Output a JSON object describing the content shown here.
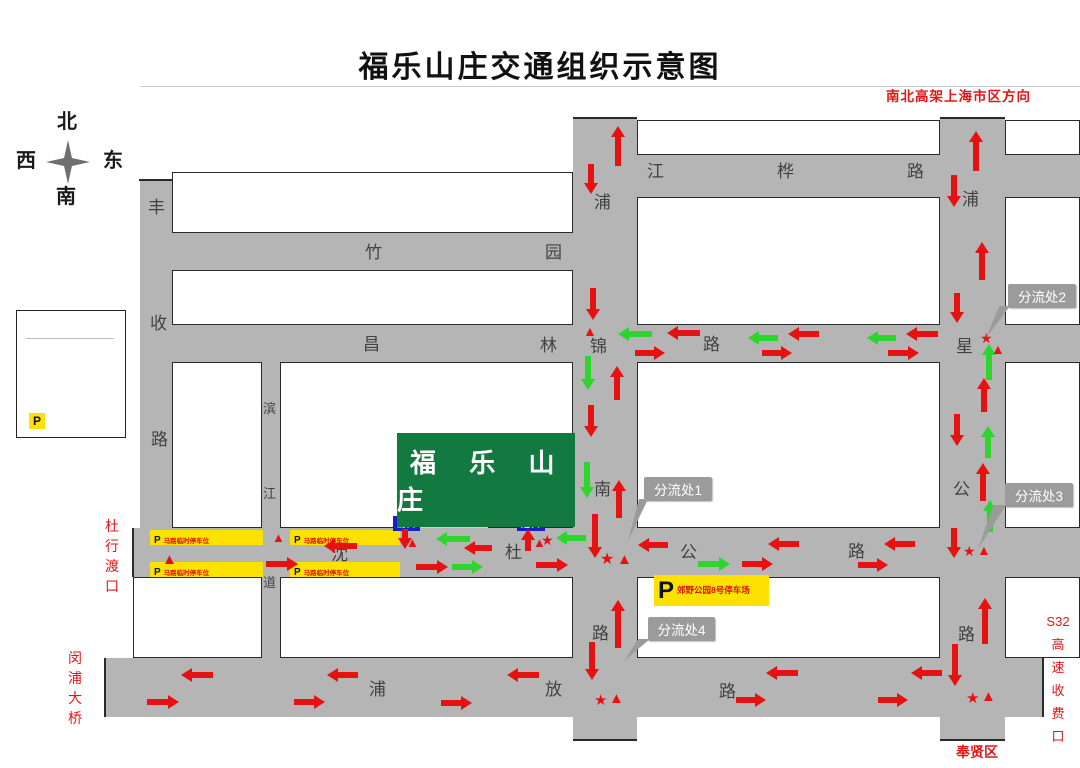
{
  "title": "福乐山庄交通组织示意图",
  "compass": {
    "north": "北",
    "south": "南",
    "east": "东",
    "west": "西"
  },
  "legend": {
    "title": "图 例",
    "items": [
      {
        "symbol": "star",
        "label": "交警岗位"
      },
      {
        "symbol": "triangle",
        "label": "特勤岗位"
      },
      {
        "symbol": "red-arrow",
        "label": "通行线路"
      },
      {
        "symbol": "green-arrow",
        "label": "短驳车通行线路"
      },
      {
        "symbol": "parking",
        "label": "停车位"
      }
    ],
    "parking_symbol": "P"
  },
  "colors": {
    "road": "#b5b5b5",
    "red": "#e61111",
    "green": "#2ed52e",
    "site_green": "#127a40",
    "yellow": "#ffe100",
    "blue": "#1c1ccd",
    "callout": "#9b9b9b",
    "label_red": "#e01717"
  },
  "roads": [
    {
      "id": "fengshou-rd",
      "rect": [
        140,
        180,
        33,
        398
      ]
    },
    {
      "id": "binjiang-lane",
      "rect": [
        262,
        362,
        18,
        296
      ]
    },
    {
      "id": "pujinnan-rd",
      "rect": [
        573,
        118,
        64,
        622
      ]
    },
    {
      "id": "puxing-hwy",
      "rect": [
        940,
        118,
        65,
        622
      ]
    },
    {
      "id": "jianghua-rd",
      "rect": [
        573,
        155,
        507,
        42
      ]
    },
    {
      "id": "zhuyuan-rd",
      "rect": [
        140,
        233,
        497,
        37
      ]
    },
    {
      "id": "changlin-rd",
      "rect": [
        140,
        325,
        940,
        37
      ]
    },
    {
      "id": "shendu-hwy",
      "rect": [
        133,
        528,
        947,
        49
      ]
    },
    {
      "id": "pufang-rd",
      "rect": [
        105,
        658,
        938,
        59
      ]
    }
  ],
  "road_chars": [
    {
      "t": "江",
      "x": 647,
      "y": 163
    },
    {
      "t": "桦",
      "x": 777,
      "y": 163
    },
    {
      "t": "路",
      "x": 907,
      "y": 163
    },
    {
      "t": "竹",
      "x": 365,
      "y": 244
    },
    {
      "t": "园",
      "x": 545,
      "y": 244
    },
    {
      "t": "昌",
      "x": 363,
      "y": 336
    },
    {
      "t": "林",
      "x": 540,
      "y": 337
    },
    {
      "t": "路",
      "x": 703,
      "y": 336
    },
    {
      "t": "沈",
      "x": 331,
      "y": 546
    },
    {
      "t": "杜",
      "x": 505,
      "y": 544
    },
    {
      "t": "公",
      "x": 680,
      "y": 544
    },
    {
      "t": "路",
      "x": 848,
      "y": 543
    },
    {
      "t": "浦",
      "x": 369,
      "y": 681
    },
    {
      "t": "放",
      "x": 545,
      "y": 681
    },
    {
      "t": "路",
      "x": 719,
      "y": 683
    },
    {
      "t": "丰",
      "x": 148,
      "y": 199
    },
    {
      "t": "收",
      "x": 150,
      "y": 315
    },
    {
      "t": "路",
      "x": 151,
      "y": 431
    },
    {
      "t": "滨",
      "x": 263,
      "y": 402,
      "s": 13
    },
    {
      "t": "江",
      "x": 263,
      "y": 487,
      "s": 13
    },
    {
      "t": "道",
      "x": 263,
      "y": 576,
      "s": 13
    },
    {
      "t": "浦",
      "x": 594,
      "y": 194
    },
    {
      "t": "锦",
      "x": 590,
      "y": 338
    },
    {
      "t": "南",
      "x": 594,
      "y": 481
    },
    {
      "t": "路",
      "x": 592,
      "y": 625
    },
    {
      "t": "浦",
      "x": 962,
      "y": 191
    },
    {
      "t": "星",
      "x": 956,
      "y": 338
    },
    {
      "t": "公",
      "x": 953,
      "y": 481
    },
    {
      "t": "路",
      "x": 958,
      "y": 626
    }
  ],
  "blocks": [
    [
      637,
      120,
      303,
      35
    ],
    [
      1005,
      120,
      75,
      35
    ],
    [
      637,
      197,
      303,
      128
    ],
    [
      1005,
      197,
      75,
      128
    ],
    [
      172,
      172,
      401,
      61
    ],
    [
      172,
      270,
      401,
      55
    ],
    [
      172,
      362,
      90,
      166
    ],
    [
      280,
      362,
      293,
      166
    ],
    [
      637,
      362,
      303,
      166
    ],
    [
      1005,
      362,
      75,
      166
    ],
    [
      133,
      577,
      129,
      81
    ],
    [
      280,
      577,
      293,
      81
    ],
    [
      637,
      577,
      303,
      81
    ],
    [
      1005,
      577,
      75,
      81
    ]
  ],
  "caps": [
    [
      573,
      117,
      64,
      2
    ],
    [
      940,
      117,
      65,
      2
    ],
    [
      139,
      179,
      34,
      2
    ],
    [
      132,
      528,
      2,
      49
    ],
    [
      104,
      658,
      2,
      59
    ],
    [
      1042,
      658,
      2,
      59
    ],
    [
      573,
      739,
      64,
      2
    ],
    [
      940,
      739,
      65,
      2
    ]
  ],
  "site": {
    "name": "福 乐 山 庄",
    "rect": [
      397,
      433,
      178,
      94
    ]
  },
  "site_parking": {
    "p": "P",
    "label": "福乐山庄停车场",
    "rect": [
      412,
      505,
      76,
      23
    ]
  },
  "park8": {
    "p": "P",
    "label": "郊野公园8号停车场",
    "rect": [
      654,
      575,
      115,
      31
    ]
  },
  "gates": [
    {
      "id": "exit-gate",
      "label": "出口",
      "rect": [
        393,
        516,
        27,
        15
      ]
    },
    {
      "id": "entry-gate",
      "label": "进口",
      "rect": [
        517,
        516,
        28,
        15
      ]
    }
  ],
  "strips": [
    {
      "rect": [
        150,
        530,
        113,
        15
      ],
      "p": "P",
      "label": "马路临时停车位"
    },
    {
      "rect": [
        290,
        530,
        110,
        15
      ],
      "p": "P",
      "label": "马路临时停车位"
    },
    {
      "rect": [
        150,
        562,
        113,
        15
      ],
      "p": "P",
      "label": "马路临时停车位"
    },
    {
      "rect": [
        290,
        562,
        110,
        15
      ],
      "p": "P",
      "label": "马路临时停车位"
    }
  ],
  "callouts": [
    {
      "text": "分流处1",
      "rect": [
        644,
        477,
        68,
        24
      ],
      "tail": [
        628,
        499,
        20,
        42
      ]
    },
    {
      "text": "分流处2",
      "rect": [
        1008,
        284,
        68,
        24
      ],
      "tail": [
        986,
        306,
        24,
        32
      ]
    },
    {
      "text": "分流处3",
      "rect": [
        1005,
        483,
        68,
        24
      ],
      "tail": [
        978,
        505,
        28,
        44
      ]
    },
    {
      "text": "分流处4",
      "rect": [
        648,
        617,
        67,
        24
      ],
      "tail": [
        624,
        639,
        26,
        22
      ]
    }
  ],
  "red_labels": [
    {
      "text": "南北高架上海市区方向",
      "x": 886,
      "y": 90,
      "size": 13.5,
      "bold": true,
      "ls": 1
    },
    {
      "lines": [
        "杜",
        "行",
        "渡",
        "口"
      ],
      "x": 105,
      "y": 516,
      "size": 14,
      "lh": 20
    },
    {
      "lines": [
        "闵",
        "浦",
        "大",
        "桥"
      ],
      "x": 68,
      "y": 648,
      "size": 14,
      "lh": 20
    },
    {
      "lines": [
        "S32",
        "高",
        "速",
        "收",
        "费",
        "口"
      ],
      "x": 1040,
      "y": 610,
      "size": 13,
      "lh": 23,
      "w": 36
    },
    {
      "text": "奉贤区",
      "x": 956,
      "y": 745,
      "size": 14,
      "bold": true
    }
  ],
  "arrows": [
    [
      611,
      126,
      40,
      "u",
      "r"
    ],
    [
      584,
      164,
      30,
      "d",
      "r"
    ],
    [
      586,
      288,
      32,
      "d",
      "r"
    ],
    [
      581,
      356,
      34,
      "d",
      "g"
    ],
    [
      610,
      366,
      34,
      "u",
      "r"
    ],
    [
      584,
      405,
      32,
      "d",
      "r"
    ],
    [
      580,
      462,
      36,
      "d",
      "g"
    ],
    [
      612,
      480,
      38,
      "u",
      "r"
    ],
    [
      588,
      514,
      44,
      "d",
      "r"
    ],
    [
      585,
      642,
      38,
      "d",
      "r"
    ],
    [
      611,
      600,
      48,
      "u",
      "r"
    ],
    [
      969,
      131,
      40,
      "u",
      "r"
    ],
    [
      947,
      175,
      32,
      "d",
      "r"
    ],
    [
      975,
      242,
      38,
      "u",
      "r"
    ],
    [
      950,
      293,
      30,
      "d",
      "r"
    ],
    [
      982,
      344,
      36,
      "u",
      "g"
    ],
    [
      977,
      378,
      34,
      "u",
      "r"
    ],
    [
      950,
      414,
      32,
      "d",
      "r"
    ],
    [
      981,
      426,
      32,
      "u",
      "g"
    ],
    [
      976,
      463,
      38,
      "u",
      "r"
    ],
    [
      983,
      500,
      32,
      "u",
      "g"
    ],
    [
      947,
      528,
      30,
      "d",
      "r"
    ],
    [
      978,
      598,
      46,
      "u",
      "r"
    ],
    [
      948,
      644,
      42,
      "d",
      "r"
    ],
    [
      618,
      327,
      34,
      "l",
      "g"
    ],
    [
      667,
      326,
      33,
      "l",
      "r"
    ],
    [
      748,
      331,
      30,
      "l",
      "g"
    ],
    [
      788,
      327,
      31,
      "l",
      "r"
    ],
    [
      867,
      331,
      29,
      "l",
      "g"
    ],
    [
      906,
      327,
      32,
      "l",
      "r"
    ],
    [
      635,
      346,
      30,
      "r",
      "r"
    ],
    [
      762,
      346,
      30,
      "r",
      "r"
    ],
    [
      888,
      346,
      31,
      "r",
      "r"
    ],
    [
      324,
      539,
      33,
      "l",
      "r"
    ],
    [
      266,
      557,
      32,
      "r",
      "r"
    ],
    [
      398,
      529,
      20,
      "d",
      "r"
    ],
    [
      436,
      532,
      34,
      "l",
      "g"
    ],
    [
      464,
      541,
      28,
      "l",
      "r"
    ],
    [
      521,
      529,
      22,
      "u",
      "r"
    ],
    [
      556,
      531,
      30,
      "l",
      "g"
    ],
    [
      416,
      560,
      32,
      "r",
      "r"
    ],
    [
      452,
      560,
      31,
      "r",
      "g"
    ],
    [
      536,
      558,
      32,
      "r",
      "r"
    ],
    [
      638,
      538,
      30,
      "l",
      "r"
    ],
    [
      768,
      537,
      31,
      "l",
      "r"
    ],
    [
      884,
      537,
      31,
      "l",
      "r"
    ],
    [
      698,
      557,
      32,
      "r",
      "g"
    ],
    [
      742,
      557,
      31,
      "r",
      "r"
    ],
    [
      858,
      558,
      30,
      "r",
      "r"
    ],
    [
      181,
      668,
      32,
      "l",
      "r"
    ],
    [
      147,
      695,
      32,
      "r",
      "r"
    ],
    [
      327,
      668,
      31,
      "l",
      "r"
    ],
    [
      294,
      695,
      31,
      "r",
      "r"
    ],
    [
      507,
      668,
      32,
      "l",
      "r"
    ],
    [
      441,
      696,
      31,
      "r",
      "r"
    ],
    [
      766,
      666,
      32,
      "l",
      "r"
    ],
    [
      736,
      693,
      30,
      "r",
      "r"
    ],
    [
      911,
      666,
      31,
      "l",
      "r"
    ],
    [
      878,
      693,
      30,
      "r",
      "r"
    ],
    [
      24,
      386,
      28,
      "r",
      "r"
    ],
    [
      24,
      404,
      28,
      "r",
      "g"
    ]
  ],
  "markers": [
    [
      "s",
      600,
      552,
      16
    ],
    [
      "t",
      617,
      552,
      15
    ],
    [
      "s",
      541,
      533,
      14
    ],
    [
      "t",
      533,
      536,
      13
    ],
    [
      "t",
      406,
      536,
      13
    ],
    [
      "t",
      162,
      552,
      15
    ],
    [
      "t",
      272,
      531,
      13
    ],
    [
      "s",
      980,
      331,
      14
    ],
    [
      "t",
      991,
      342,
      14
    ],
    [
      "s",
      963,
      544,
      14
    ],
    [
      "t",
      977,
      543,
      14
    ],
    [
      "s",
      594,
      693,
      15
    ],
    [
      "t",
      609,
      691,
      15
    ],
    [
      "s",
      966,
      691,
      15
    ],
    [
      "t",
      981,
      689,
      15
    ],
    [
      "t",
      583,
      324,
      14
    ],
    [
      "s",
      30,
      344,
      15
    ],
    [
      "t",
      31,
      363,
      14
    ]
  ],
  "texts": [
    {
      "t": "北",
      "x": 57,
      "y": 112,
      "s": 20,
      "b": true,
      "f": "serif"
    },
    {
      "t": "西",
      "x": 16,
      "y": 151,
      "s": 20,
      "b": true,
      "f": "serif"
    },
    {
      "t": "东",
      "x": 103,
      "y": 151,
      "s": 20,
      "b": true,
      "f": "serif"
    },
    {
      "t": "南",
      "x": 56,
      "y": 187,
      "s": 20,
      "b": true,
      "f": "serif"
    },
    {
      "t": "图 例",
      "x": 50,
      "y": 315,
      "s": 15,
      "b": true,
      "ls": 5
    },
    {
      "t": "交警岗位",
      "x": 56,
      "y": 346,
      "s": 10
    },
    {
      "t": "特勤岗位",
      "x": 56,
      "y": 365,
      "s": 10
    },
    {
      "t": "通行线路",
      "x": 56,
      "y": 384,
      "s": 10
    },
    {
      "t": "短驳车通行线路",
      "x": 56,
      "y": 402,
      "s": 9
    },
    {
      "t": "停车位",
      "x": 56,
      "y": 419,
      "s": 10
    }
  ]
}
